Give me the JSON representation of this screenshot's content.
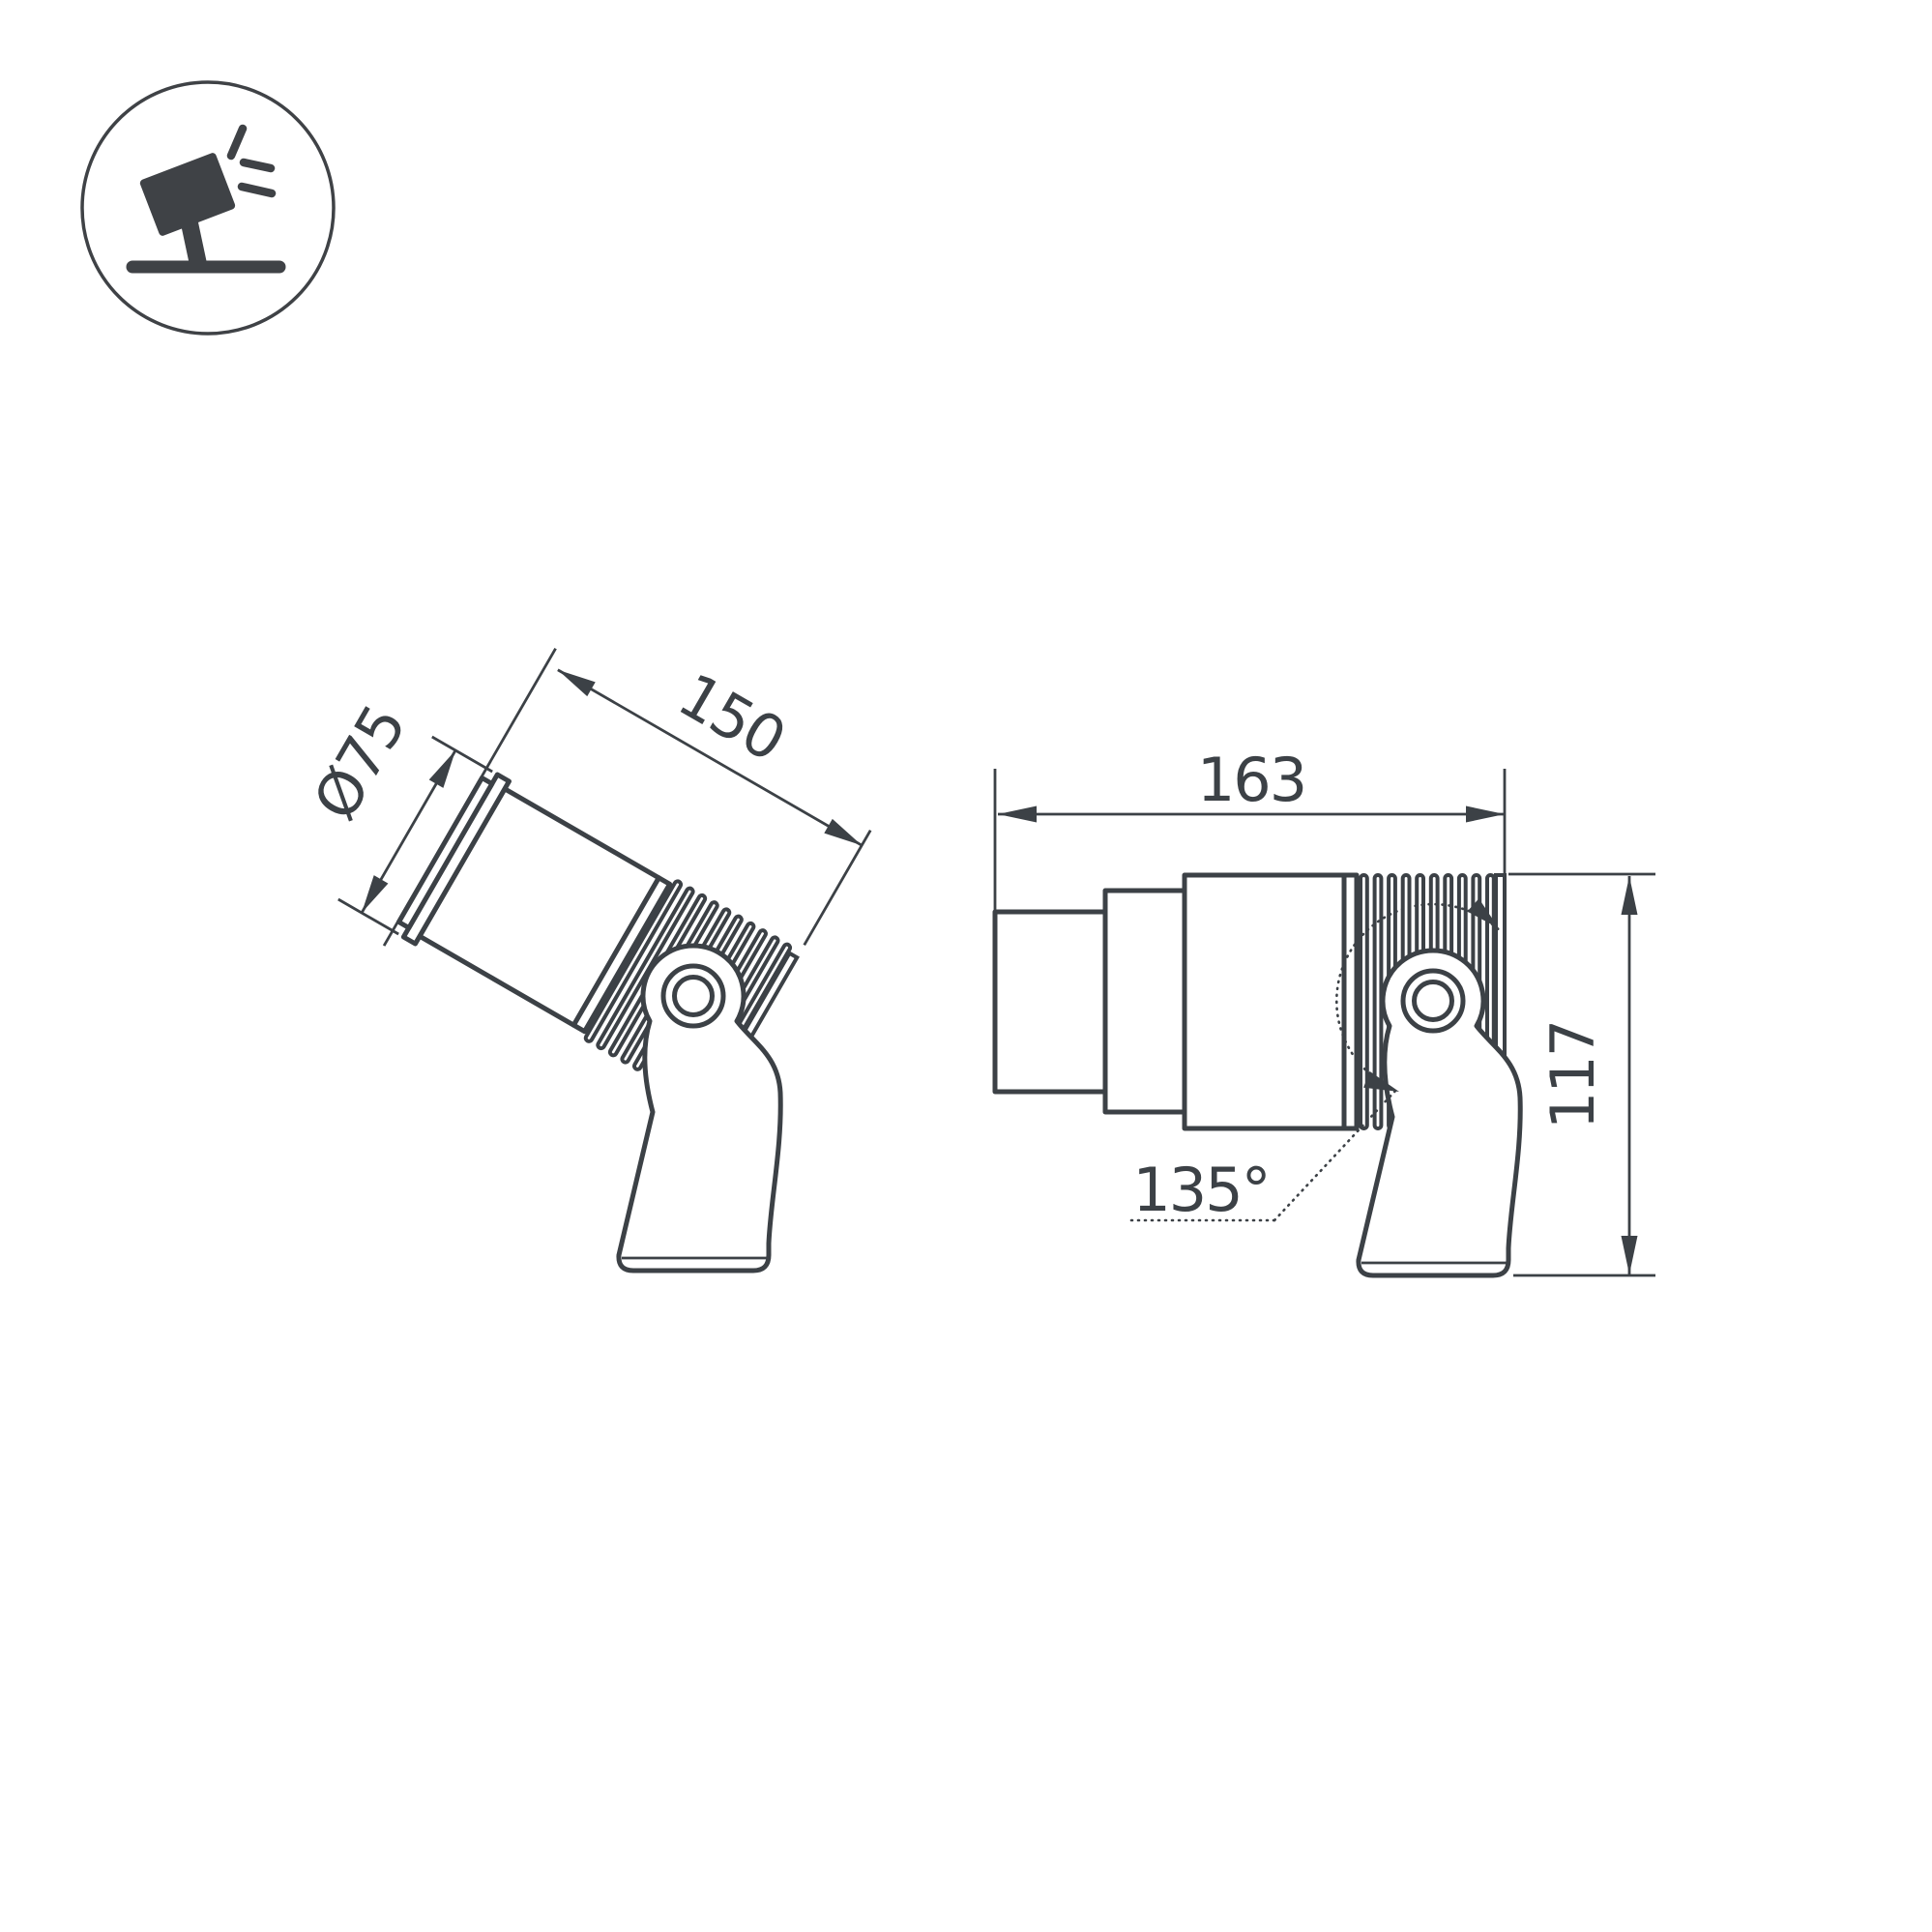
{
  "page": {
    "background_color": "#ffffff",
    "line_color": "#3c4146",
    "description": "Technical dimension drawing of an adjustable LED spotlight on a tilting bracket, two projections"
  },
  "icon": {
    "name": "adjustable-spotlight-icon",
    "style": "tilted spotlight head with light rays on a stand inside a circle"
  },
  "views": {
    "left": {
      "name": "tilted-view",
      "tilt_degrees": 30,
      "dimensions": {
        "diameter": "Ø75",
        "length": "150"
      }
    },
    "right": {
      "name": "side-view",
      "dimensions": {
        "length": "163",
        "height": "117",
        "rotation_angle": "135°"
      }
    }
  }
}
